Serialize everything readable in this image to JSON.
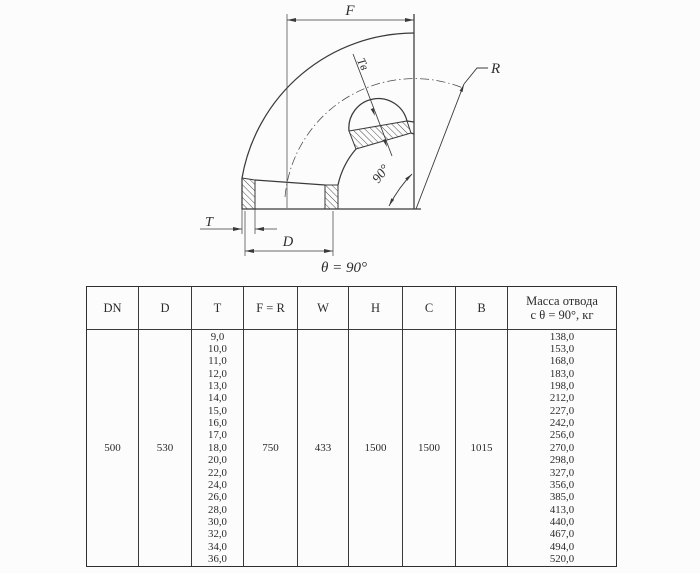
{
  "diagram": {
    "dim_f": "F",
    "dim_r": "R",
    "dim_t_inner": "Tв",
    "dim_t": "T",
    "dim_d": "D",
    "angle_label": "90°",
    "theta_caption": "θ = 90°"
  },
  "table": {
    "headers": [
      "DN",
      "D",
      "T",
      "F = R",
      "W",
      "H",
      "C",
      "B"
    ],
    "mass_header": [
      "Масса отвода",
      "с θ =  90°, кг"
    ],
    "values": {
      "dn": "500",
      "d": "530",
      "f_r": "750",
      "w": "433",
      "h": "1500",
      "c": "1500",
      "b": "1015"
    },
    "t_values": [
      "9,0",
      "10,0",
      "11,0",
      "12,0",
      "13,0",
      "14,0",
      "15,0",
      "16,0",
      "17,0",
      "18,0",
      "20,0",
      "22,0",
      "24,0",
      "26,0",
      "28,0",
      "30,0",
      "32,0",
      "34,0",
      "36,0"
    ],
    "mass_values": [
      "138,0",
      "153,0",
      "168,0",
      "183,0",
      "198,0",
      "212,0",
      "227,0",
      "242,0",
      "256,0",
      "270,0",
      "298,0",
      "327,0",
      "356,0",
      "385,0",
      "413,0",
      "440,0",
      "467,0",
      "494,0",
      "520,0"
    ]
  },
  "colors": {
    "line": "#3a3a3a",
    "text": "#2b2b2b",
    "background": "#fcfcfc"
  }
}
